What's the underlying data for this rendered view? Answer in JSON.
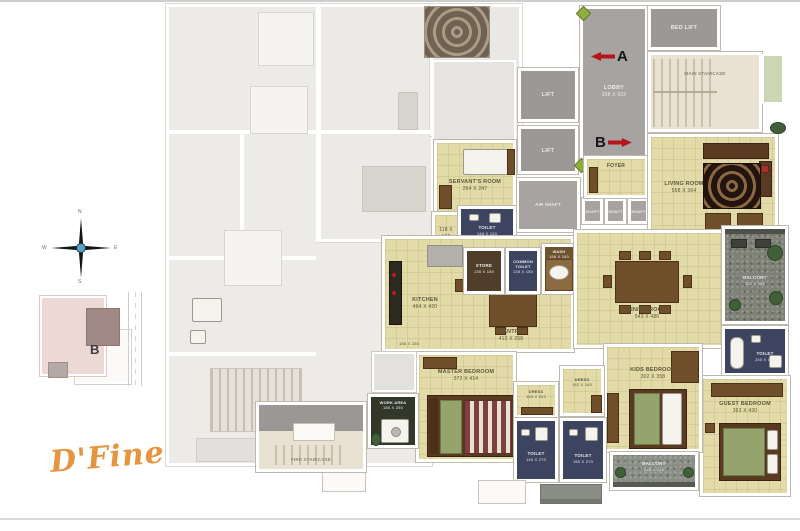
{
  "page": {
    "brand": "D'Fine"
  },
  "key_plan": {
    "unit_letter": "B"
  },
  "compass": {
    "n": "N",
    "e": "E",
    "s": "S",
    "w": "W"
  },
  "markers": {
    "a": "A",
    "b": "B"
  },
  "colors": {
    "accent_red": "#b5161a",
    "floor_cream": "#e2dba8",
    "toilet_navy": "#3c445f",
    "circulation_gray": "#a6a3a1",
    "balcony_stone": "#7e8176",
    "wood_brown": "#6f4e2a",
    "logo_orange": "#e6943d"
  },
  "rooms": {
    "lobby": {
      "name": "LOBBY",
      "dims": "208 X 602"
    },
    "bed_lift": {
      "name": "BED LIFT"
    },
    "main_staircase": {
      "name": "MAIN STAIRCASE"
    },
    "lift_1": {
      "name": "LIFT"
    },
    "lift_2": {
      "name": "LIFT"
    },
    "air_shaft": {
      "name": "AIR SHAFT"
    },
    "shaft_1": {
      "name": "SHAFT"
    },
    "shaft_2": {
      "name": "SHAFT"
    },
    "shaft_3": {
      "name": "SHAFT"
    },
    "foyer": {
      "name": "FOYER"
    },
    "living_room": {
      "name": "LIVING ROOM",
      "dims": "558 X 364"
    },
    "servants_room": {
      "name": "SERVANT'S ROOM",
      "dims": "264 X 247"
    },
    "servant_toilet": {
      "name": "TOILET",
      "dims": "148 X 120"
    },
    "passage": {
      "dims": "118 X 132"
    },
    "store": {
      "name": "STORE",
      "dims": "135 X 150"
    },
    "common_toilet": {
      "name": "COMMON TOILET",
      "dims": "135 X 150"
    },
    "wash": {
      "name": "WASH",
      "dims": "186 X 150"
    },
    "kitchen": {
      "name": "KITCHEN",
      "dims": "464 X 420"
    },
    "kitchen_side": {
      "dims": "186 X 236"
    },
    "pantry": {
      "name": "PANTRY",
      "dims": "410 X 258"
    },
    "dining_room": {
      "name": "DINING ROOM",
      "dims": "543 X 486"
    },
    "living_balcony": {
      "name": "BALCONY",
      "dims": "200 X 665"
    },
    "guest_toilet": {
      "name": "TOILET",
      "dims": "240 X 150"
    },
    "guest_bedroom": {
      "name": "GUEST BEDROOM",
      "dims": "363 X 430"
    },
    "kids_bedroom": {
      "name": "KIDS BEDROOM",
      "dims": "302 X 358"
    },
    "kids_balcony": {
      "name": "BALCONY",
      "dims": "240 X 120"
    },
    "master_bedroom": {
      "name": "MASTER BEDROOM",
      "dims": "372 X 414"
    },
    "master_dress": {
      "name": "DRESS",
      "dims": "180 X 202"
    },
    "kids_dress": {
      "name": "DRESS",
      "dims": "182 X 160"
    },
    "master_toilet": {
      "name": "TOILET",
      "dims": "140 X 270"
    },
    "kids_toilet": {
      "name": "TOILET",
      "dims": "150 X 270"
    },
    "work_area": {
      "name": "WORK AREA",
      "dims": "186 X 250"
    },
    "fire_staircase": {
      "name": "FIRE STAIRCASE"
    }
  }
}
